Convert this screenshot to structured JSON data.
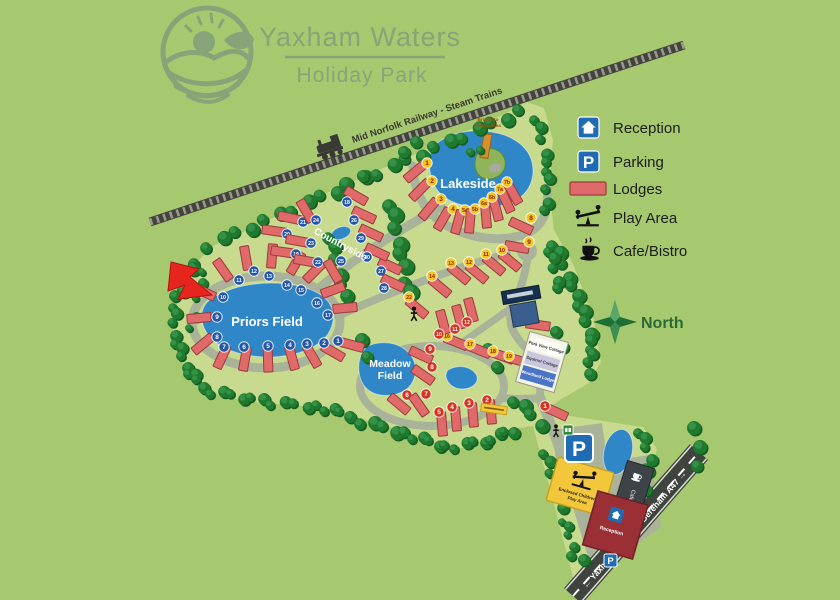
{
  "title": {
    "line1": "Yaxham Waters",
    "line2": "Holiday Park"
  },
  "railway_label": "Mid Norfolk Railway - Steam Trains",
  "legend": {
    "items": [
      {
        "id": "reception",
        "label": "Reception"
      },
      {
        "id": "parking",
        "label": "Parking"
      },
      {
        "id": "lodges",
        "label": "Lodges"
      },
      {
        "id": "play-area",
        "label": "Play Area"
      },
      {
        "id": "cafe",
        "label": "Cafe/Bistro"
      }
    ]
  },
  "compass_label": "North",
  "areas": {
    "lakeside": "Lakeside",
    "priors_field": "Priors Field",
    "meadow_line1": "Meadow",
    "meadow_line2": "Field",
    "countryside": "Countryside"
  },
  "bridge_label": {
    "line1": "Bridge to",
    "line2": "Picnic Area"
  },
  "signs": {
    "play_area_line1": "Enclosed Children's",
    "play_area_line2": "Play Area",
    "reception": "Reception",
    "cafe": "Cafe/Bistro",
    "cottages": [
      "Park View Cottage",
      "Squirrel Cottage",
      "Woodland Lodge"
    ],
    "parking_letter": "P"
  },
  "roads": {
    "southwest": "← Yaxham B1135",
    "northeast": "Dereham A47 →"
  },
  "colors": {
    "background": "#a6c86f",
    "park": "#c7da8e",
    "road": "#a9b399",
    "lake": "#2f87c8",
    "lodge": "#e0696a",
    "lodge_edge": "#9c3b3b",
    "legend_blue": "#1f6cb5",
    "badge_yellow": "#f6c51d",
    "badge_blue": "#2457a8",
    "badge_red": "#d43420",
    "railway": "#44443e",
    "north_green": "#1e6f35",
    "arrow_red": "#e8251d",
    "title_green": "#87a478"
  },
  "lodge_series": [
    {
      "name": "lakeside",
      "badge_fill": "#f6c51d",
      "badge_text": "#8b1c12",
      "items": [
        [
          "1",
          427,
          163,
          415,
          172,
          140
        ],
        [
          "2",
          432,
          181,
          420,
          190,
          135
        ],
        [
          "3",
          441,
          199,
          429,
          209,
          130
        ],
        [
          "4",
          453,
          209,
          443,
          219,
          120
        ],
        [
          "5a",
          465,
          210,
          458,
          222,
          105
        ],
        [
          "5b",
          475,
          209,
          470,
          221,
          95
        ],
        [
          "6a",
          484,
          203,
          486,
          216,
          85
        ],
        [
          "6b",
          492,
          197,
          496,
          209,
          75
        ],
        [
          "7a",
          500,
          189,
          506,
          201,
          65
        ],
        [
          "7b",
          507,
          182,
          513,
          193,
          60
        ],
        [
          "8",
          531,
          218,
          521,
          226,
          25
        ],
        [
          "9",
          529,
          242,
          517,
          247,
          10
        ],
        [
          "10",
          502,
          250,
          510,
          261,
          40
        ],
        [
          "11",
          486,
          254,
          494,
          265,
          40
        ],
        [
          "12",
          469,
          262,
          477,
          273,
          40
        ],
        [
          "13",
          451,
          263,
          459,
          274,
          40
        ],
        [
          "14",
          432,
          276,
          440,
          287,
          40
        ],
        [
          "15",
          524,
          320,
          538,
          325,
          8
        ],
        [
          "16",
          447,
          336,
          456,
          342,
          22
        ],
        [
          "17",
          470,
          344,
          479,
          350,
          22
        ],
        [
          "18",
          493,
          351,
          502,
          356,
          20
        ],
        [
          "19",
          509,
          356,
          517,
          360,
          16
        ],
        [
          "22",
          409,
          297,
          417,
          308,
          40
        ]
      ]
    },
    {
      "name": "priors",
      "badge_fill": "#2457a8",
      "badge_text": "#ffffff",
      "items": [
        [
          "1",
          338,
          341,
          352,
          345,
          15
        ],
        [
          "2",
          324,
          343,
          333,
          352,
          30
        ],
        [
          "3",
          307,
          344,
          312,
          356,
          60
        ],
        [
          "4",
          290,
          345,
          292,
          358,
          75
        ],
        [
          "5",
          268,
          346,
          268,
          360,
          88
        ],
        [
          "6",
          244,
          347,
          245,
          359,
          100
        ],
        [
          "7",
          224,
          347,
          222,
          357,
          115
        ],
        [
          "8",
          217,
          337,
          203,
          344,
          140
        ],
        [
          "9",
          217,
          317,
          199,
          318,
          175
        ],
        [
          "10",
          223,
          297,
          204,
          292,
          205
        ],
        [
          "11",
          239,
          280,
          223,
          270,
          235
        ],
        [
          "12",
          254,
          271,
          246,
          258,
          260
        ],
        [
          "13",
          269,
          276,
          272,
          256,
          275
        ],
        [
          "14",
          287,
          285,
          296,
          263,
          300
        ],
        [
          "15",
          301,
          290,
          314,
          272,
          315
        ],
        [
          "16",
          317,
          303,
          333,
          290,
          340
        ],
        [
          "17",
          328,
          315,
          345,
          308,
          355
        ]
      ]
    },
    {
      "name": "countryside",
      "badge_fill": "#2457a8",
      "badge_text": "#ffffff",
      "items": [
        [
          "18",
          347,
          202,
          356,
          196,
          30
        ],
        [
          "19",
          296,
          254,
          283,
          252,
          8
        ],
        [
          "20",
          287,
          234,
          274,
          231,
          8
        ],
        [
          "21",
          303,
          222,
          290,
          218,
          12
        ],
        [
          "22",
          318,
          262,
          306,
          261,
          10
        ],
        [
          "23",
          311,
          243,
          298,
          241,
          10
        ],
        [
          "24",
          316,
          220,
          306,
          211,
          60
        ],
        [
          "25",
          341,
          261,
          333,
          271,
          60
        ],
        [
          "26",
          354,
          220,
          364,
          215,
          25
        ],
        [
          "27",
          381,
          271,
          390,
          266,
          25
        ],
        [
          "28",
          384,
          288,
          393,
          283,
          25
        ],
        [
          "29",
          361,
          238,
          371,
          233,
          25
        ],
        [
          "30",
          367,
          257,
          377,
          252,
          25
        ]
      ]
    },
    {
      "name": "meadow",
      "badge_fill": "#d43420",
      "badge_text": "#ffffff",
      "items": [
        [
          "1",
          545,
          406,
          556,
          412,
          25
        ],
        [
          "2",
          487,
          400,
          491,
          412,
          85
        ],
        [
          "3",
          469,
          403,
          473,
          415,
          85
        ],
        [
          "4",
          452,
          407,
          456,
          419,
          85
        ],
        [
          "5",
          439,
          412,
          442,
          424,
          85
        ],
        [
          "6",
          407,
          395,
          399,
          404,
          40
        ],
        [
          "7",
          426,
          394,
          419,
          405,
          55
        ],
        [
          "8",
          432,
          367,
          423,
          375,
          35
        ],
        [
          "9",
          430,
          349,
          421,
          355,
          25
        ],
        [
          "10",
          439,
          334,
          443,
          322,
          75
        ],
        [
          "11",
          455,
          329,
          459,
          317,
          75
        ],
        [
          "12",
          467,
          322,
          471,
          310,
          75
        ]
      ]
    }
  ]
}
